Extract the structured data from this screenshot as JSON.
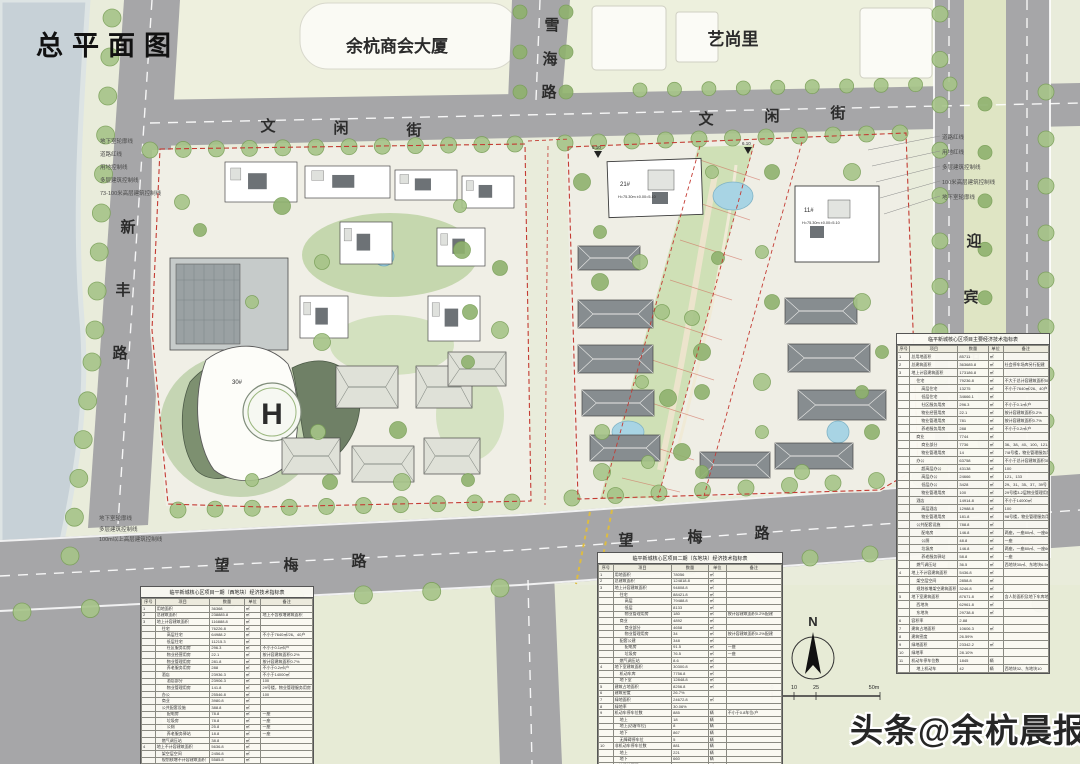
{
  "page": {
    "title": "总平面图"
  },
  "areas": {
    "chamber": "余杭商会大厦",
    "yishangli": "艺尚里"
  },
  "road_chars": {
    "xuehai": [
      "雪",
      "海",
      "路"
    ],
    "wenxian": [
      "文",
      "闲",
      "街"
    ],
    "xinfeng": [
      "新",
      "丰",
      "路"
    ],
    "yingbin": [
      "迎",
      "宾",
      "路"
    ],
    "wangmei": [
      "望",
      "梅",
      "路"
    ]
  },
  "annotations": {
    "left": [
      "地下室轮廓线",
      "道路红线",
      "用地控制线",
      "多层建筑控制线",
      "73-100米高层建筑控制线"
    ],
    "right": [
      "道路红线",
      "用地红线",
      "多层建筑控制线",
      "100米高层建筑控制线",
      "地下室轮廓线"
    ],
    "bottom_left": [
      "地下室轮廓线",
      "多层建筑控制线",
      "100m以上高层建筑控制线"
    ]
  },
  "plan_labels": {
    "helipad": "H",
    "tower30": "30#",
    "tower21": "21#",
    "tower11": "11#",
    "tower21_info": "H=75.30m ±0.00=5.10",
    "tower11_info": "H=75.30m ±0.00=5.10",
    "elev1": "5.10",
    "elev2": "6.10"
  },
  "compass": {
    "label": "N"
  },
  "scale_bar": {
    "ticks": [
      "0",
      "10",
      "25",
      "50m"
    ]
  },
  "watermark": {
    "prefix": "头条",
    "handle": "@余杭晨报"
  },
  "tables": [
    {
      "title": "临平新城核心区项目一期（西地块）经济技术指标表",
      "columns": [
        "序号",
        "项目",
        "数量",
        "单位",
        "备注"
      ],
      "rows": [
        [
          "1",
          "用地面积",
          "36368",
          "㎡",
          "",
          0
        ],
        [
          "2",
          "总建筑面积",
          "238885.8",
          "㎡",
          "地上不含核增建筑面积",
          0
        ],
        [
          "3",
          "地上计容建筑面积",
          "116888.8",
          "㎡",
          "",
          0
        ],
        [
          "",
          "住宅",
          "76226.8",
          "㎡",
          "",
          1
        ],
        [
          "",
          "高层住宅",
          "64988.2",
          "㎡",
          "不小于7640㎡/26、40户",
          2
        ],
        [
          "",
          "低层住宅",
          "11215.3",
          "㎡",
          "",
          2
        ],
        [
          "",
          "社区服务用房",
          "296.3",
          "㎡",
          "不小于0.1㎡/户",
          2
        ],
        [
          "",
          "物业经营用房",
          "22.1",
          "㎡",
          "按计容建筑面积0.2%",
          2
        ],
        [
          "",
          "物业管理用房",
          "281.8",
          "㎡",
          "按计容建筑面积0.7%",
          2
        ],
        [
          "",
          "养老服务用房",
          "288",
          "㎡",
          "不小于0.2㎡/户",
          2
        ],
        [
          "",
          "酒店",
          "23936.3",
          "㎡",
          "不小于14000㎡",
          1
        ],
        [
          "",
          "酒店部分",
          "23906.3",
          "㎡",
          "100",
          2
        ],
        [
          "",
          "物业管理用房",
          "141.8",
          "㎡",
          "29号楼，物业管理服务用房",
          2
        ],
        [
          "",
          "办公",
          "25546.8",
          "㎡",
          "100",
          1
        ],
        [
          "",
          "商业",
          "3980.8",
          "㎡",
          "",
          1
        ],
        [
          "",
          "公共配套设施",
          "388.8",
          "㎡",
          "",
          1
        ],
        [
          "",
          "配电房",
          "78.8",
          "㎡",
          "一座",
          2
        ],
        [
          "",
          "垃圾房",
          "78.8",
          "㎡",
          "一座",
          2
        ],
        [
          "",
          "公厕",
          "25.8",
          "㎡",
          "一座",
          2
        ],
        [
          "",
          "养老服务驿站",
          "18.8",
          "㎡",
          "一座",
          2
        ],
        [
          "",
          "燃气调压站",
          "38.8",
          "㎡",
          "",
          1
        ],
        [
          "4",
          "地上不计容建筑面积",
          "5636.8",
          "㎡",
          "",
          0
        ],
        [
          "",
          "架空层空间",
          "2456.8",
          "㎡",
          "",
          1
        ],
        [
          "",
          "规划核增不计容建筑面积",
          "5585.8",
          "㎡",
          "",
          1
        ]
      ]
    },
    {
      "title": "临平新城核心区项目二期（东地块）经济技术指标表",
      "columns": [
        "序号",
        "项目",
        "数量",
        "单位",
        "备注"
      ],
      "rows": [
        [
          "1",
          "用地面积",
          "78056",
          "㎡",
          "",
          0
        ],
        [
          "2",
          "总建筑面积",
          "124818.8",
          "㎡",
          "",
          0
        ],
        [
          "3",
          "地上计容建筑面积",
          "94808.8",
          "㎡",
          "",
          0
        ],
        [
          "",
          "住宅",
          "88421.8",
          "㎡",
          "",
          1
        ],
        [
          "",
          "高层",
          "79488.8",
          "㎡",
          "",
          2
        ],
        [
          "",
          "低层",
          "8133",
          "㎡",
          "",
          2
        ],
        [
          "",
          "物业管理用房",
          "180",
          "㎡",
          "按计容建筑面积0.2%配建",
          2
        ],
        [
          "",
          "商业",
          "4892",
          "㎡",
          "",
          1
        ],
        [
          "",
          "商业部分",
          "4658",
          "㎡",
          "",
          2
        ],
        [
          "",
          "物业管理用房",
          "34",
          "㎡",
          "按计容建筑面积0.2%配建",
          2
        ],
        [
          "",
          "配套公建",
          "348",
          "㎡",
          "",
          1
        ],
        [
          "",
          "配电房",
          "91.5",
          "㎡",
          "一座",
          2
        ],
        [
          "",
          "垃圾房",
          "76.5",
          "㎡",
          "一座",
          2
        ],
        [
          "",
          "燃气调压站",
          "8.6",
          "㎡",
          "",
          1
        ],
        [
          "4",
          "地下室建筑面积",
          "30300.8",
          "㎡",
          "",
          0
        ],
        [
          "",
          "机动车库",
          "7756.8",
          "㎡",
          "",
          1
        ],
        [
          "",
          "地下室",
          "12848.8",
          "㎡",
          "",
          1
        ],
        [
          "5",
          "建筑占地面积",
          "8256.8",
          "㎡",
          "",
          0
        ],
        [
          "6",
          "建筑密度",
          "26.7%",
          "",
          "",
          0
        ],
        [
          "7",
          "绿地面积",
          "24672.8",
          "㎡",
          "",
          0
        ],
        [
          "8",
          "绿地率",
          "30.06%",
          "",
          "",
          0
        ],
        [
          "9",
          "机动车停车位数",
          "885",
          "辆",
          "不小于0.8车位/户",
          0
        ],
        [
          "",
          "地上",
          "18",
          "辆",
          "",
          1
        ],
        [
          "",
          "地上(访客车位)",
          "8",
          "辆",
          "",
          1
        ],
        [
          "",
          "地下",
          "867",
          "辆",
          "",
          1
        ],
        [
          "",
          "无障碍停车位",
          "5",
          "辆",
          "",
          1
        ],
        [
          "10",
          "非机动车停车位数",
          "881",
          "辆",
          "",
          0
        ],
        [
          "",
          "地上",
          "221",
          "辆",
          "",
          1
        ],
        [
          "",
          "地下",
          "660",
          "辆",
          "",
          1
        ],
        [
          "11",
          "公共绿地面积",
          "75",
          "㎡",
          "",
          0
        ]
      ]
    },
    {
      "title": "临平新城核心区项目主要经济技术指标表",
      "columns": [
        "序号",
        "项目",
        "数量",
        "单位",
        "备注"
      ],
      "rows": [
        [
          "1",
          "总用地面积",
          "85711",
          "㎡",
          "",
          0
        ],
        [
          "2",
          "总建筑面积",
          "363685.8",
          "㎡",
          "社会停车场库另行配建",
          0
        ],
        [
          "3",
          "地上计容建筑面积",
          "173186.8",
          "㎡",
          "",
          0
        ],
        [
          "",
          "住宅",
          "79236.8",
          "㎡",
          "不大于总计容建筑面积50%",
          1
        ],
        [
          "",
          "高层住宅",
          "13275",
          "㎡",
          "不小于7640㎡/26、40户",
          2
        ],
        [
          "",
          "低层住宅",
          "34666.1",
          "㎡",
          "",
          2
        ],
        [
          "",
          "社区服务用房",
          "296.3",
          "㎡",
          "不小于0.1㎡/户",
          2
        ],
        [
          "",
          "物业经营用房",
          "22.1",
          "㎡",
          "按计容建筑面积0.2%",
          2
        ],
        [
          "",
          "物业管理用房",
          "781",
          "㎡",
          "按计容建筑面积0.7%",
          2
        ],
        [
          "",
          "养老服务用房",
          "288",
          "㎡",
          "不小于0.2㎡/户",
          2
        ],
        [
          "",
          "商业",
          "7744",
          "㎡",
          "",
          1
        ],
        [
          "",
          "商业部分",
          "7736",
          "㎡",
          "36、38、40、100、121-138号",
          2
        ],
        [
          "",
          "物业管理用房",
          "14",
          "㎡",
          "7/8号楼，物业管理服务用房",
          2
        ],
        [
          "",
          "办公",
          "63758",
          "㎡",
          "不小于总计容建筑面积30%",
          1
        ],
        [
          "",
          "超高层办公",
          "43138",
          "㎡",
          "100",
          2
        ],
        [
          "",
          "高层办公",
          "24666",
          "㎡",
          "121、133",
          2
        ],
        [
          "",
          "低层办公",
          "3428",
          "㎡",
          "29、31、35、37、39号",
          2
        ],
        [
          "",
          "物业管理用房",
          "100",
          "㎡",
          "29号楼3-2层物业管理用房",
          2
        ],
        [
          "",
          "酒店",
          "14914.8",
          "㎡",
          "不小于14000㎡",
          1
        ],
        [
          "",
          "高层酒店",
          "12988.8",
          "㎡",
          "100",
          2
        ],
        [
          "",
          "物业管理用房",
          "181.8",
          "㎡",
          "98号楼，物业管理服务用房",
          2
        ],
        [
          "",
          "公共配套设施",
          "788.8",
          "㎡",
          "",
          1
        ],
        [
          "",
          "配电房",
          "146.8",
          "㎡",
          "两座，一座80㎡、一座66.8㎡",
          2
        ],
        [
          "",
          "公厕",
          "48.8",
          "㎡",
          "一座",
          2
        ],
        [
          "",
          "垃圾房",
          "146.8",
          "㎡",
          "两座，一座80㎡、一座66.8㎡",
          2
        ],
        [
          "",
          "养老服务驿站",
          "58.8",
          "㎡",
          "一座",
          2
        ],
        [
          "",
          "燃气调压站",
          "36.5",
          "㎡",
          "西地块30㎡、东地块6.5㎡",
          1
        ],
        [
          "4",
          "地上不计容建筑面积",
          "5436.8",
          "㎡",
          "",
          0
        ],
        [
          "",
          "架空层空间",
          "2858.8",
          "㎡",
          "",
          1
        ],
        [
          "",
          "规划核增架空建筑面积",
          "3246.8",
          "㎡",
          "",
          1
        ],
        [
          "5",
          "地下室建筑面积",
          "87671.8",
          "㎡",
          "含人防面积及地下车库地下室",
          0
        ],
        [
          "",
          "西地块",
          "62961.8",
          "㎡",
          "",
          1
        ],
        [
          "",
          "东地块",
          "29738.8",
          "㎡",
          "",
          1
        ],
        [
          "6",
          "容积率",
          "2.88",
          "",
          "",
          0
        ],
        [
          "7",
          "建筑占地面积",
          "10606.3",
          "㎡",
          "",
          0
        ],
        [
          "8",
          "建筑密度",
          "26.59%",
          "",
          "",
          0
        ],
        [
          "9",
          "绿地面积",
          "23342.2",
          "㎡",
          "",
          0
        ],
        [
          "10",
          "绿地率",
          "28.10%",
          "",
          "",
          0
        ],
        [
          "11",
          "机动车停车位数",
          "1845",
          "辆",
          "",
          0
        ],
        [
          "",
          "地上机动车",
          "42",
          "辆",
          "西地块32、东地块10",
          1
        ]
      ]
    }
  ]
}
